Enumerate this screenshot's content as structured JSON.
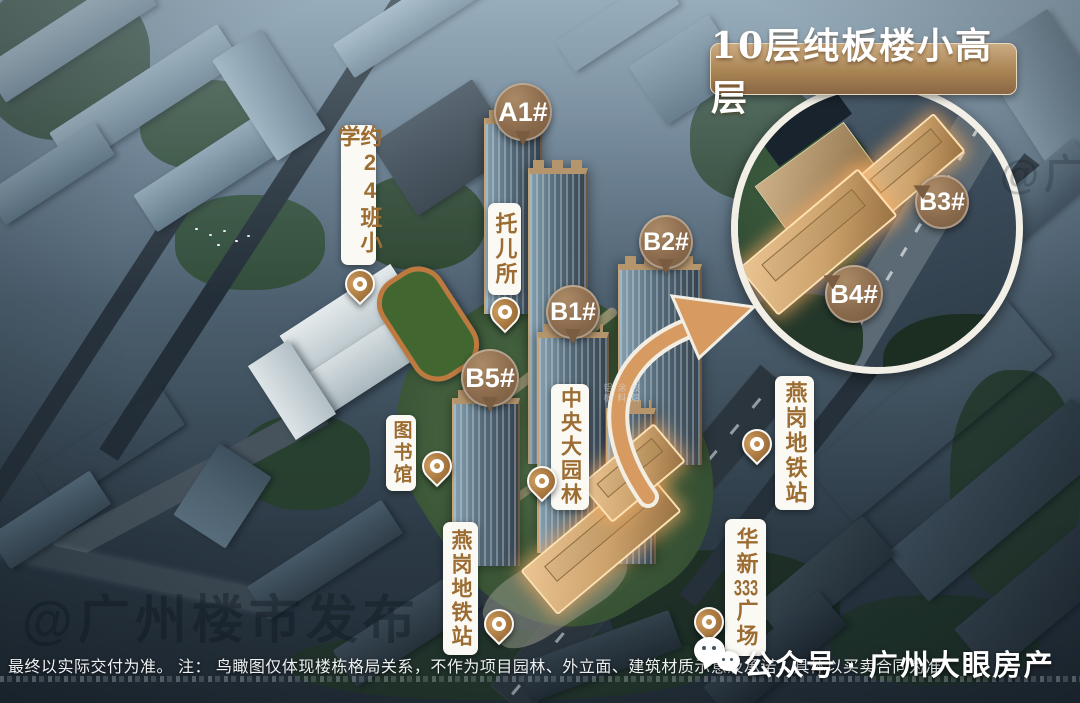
{
  "inset": {
    "banner": "10层纯板楼小高层",
    "b3": "B3#",
    "b4": "B4#"
  },
  "buildings": {
    "a1": "A1#",
    "b1": "B1#",
    "b2": "B2#",
    "b5": "B5#"
  },
  "pois": {
    "school": "约24班小学",
    "nursery": "托儿所",
    "library": "图书馆",
    "garden": "中央大园林",
    "metro_center": "燕岗地铁站",
    "metro_right": "燕岗地铁站",
    "plaza_prefix": "华新",
    "plaza_num": "333",
    "plaza_suffix": "广场"
  },
  "materials": {
    "glass": "玻璃",
    "paint": "涂料",
    "aluminum": "铝板"
  },
  "watermark": {
    "main": "@广州楼市发布",
    "corner": "@广州楼市发布"
  },
  "footer": {
    "disclaimer": "最终以实际交付为准。 注： 鸟瞰图仅体现楼栋格局关系，不作为项目园林、外立面、建筑材质示意及承诺，具体以买卖合同为准",
    "account": "公众号 · 广州大眼房产"
  },
  "colors": {
    "accent_brown": "#8a6a4c",
    "banner_top": "#cbab82",
    "label_text": "#9c6d33",
    "highlight_glow": "#f6aa60"
  }
}
